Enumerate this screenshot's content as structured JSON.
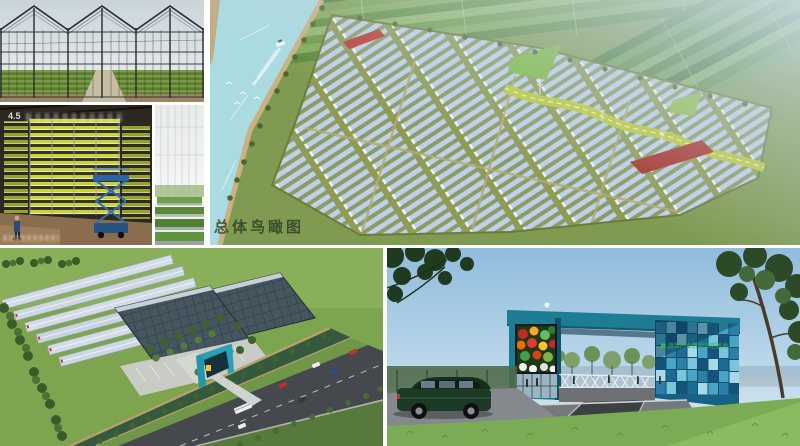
{
  "panels": {
    "greenhouse_photo": {
      "name": "glass-greenhouse-exterior-photo"
    },
    "vertical_farm": {
      "badge": "4.5"
    },
    "seedling_house": {
      "name": "seedling-greenhouse-interior-photo"
    },
    "masterplan": {
      "caption": "总体鸟瞰图"
    },
    "campus_render": {
      "name": "greenhouse-campus-aerial-render"
    },
    "gate_render": {
      "sign": "蔬菜产业转型示范基地"
    }
  },
  "colors": {
    "gutter_white": "#ffffff",
    "accent_teal": "#2aa0b4",
    "gate_teal": "#1e7d93",
    "mosaic_blues": [
      "#15537c",
      "#2b7fa8",
      "#49a5c6",
      "#79c6dc",
      "#a5d9e8",
      "#1a6c94"
    ],
    "water": "#a9dbe0",
    "greenhouse_roof": "#bfd2e4",
    "field_olive": "#8f9c52",
    "grass": "#7da44f",
    "road_asphalt": "#46484d",
    "leisure_path_yellow": "#bcca36",
    "flower_red": "#b73430",
    "sign_green": "#35b24a",
    "vfarm_lit_shelf": "#ccdb31",
    "caption_ink": "#2e3d1f"
  }
}
